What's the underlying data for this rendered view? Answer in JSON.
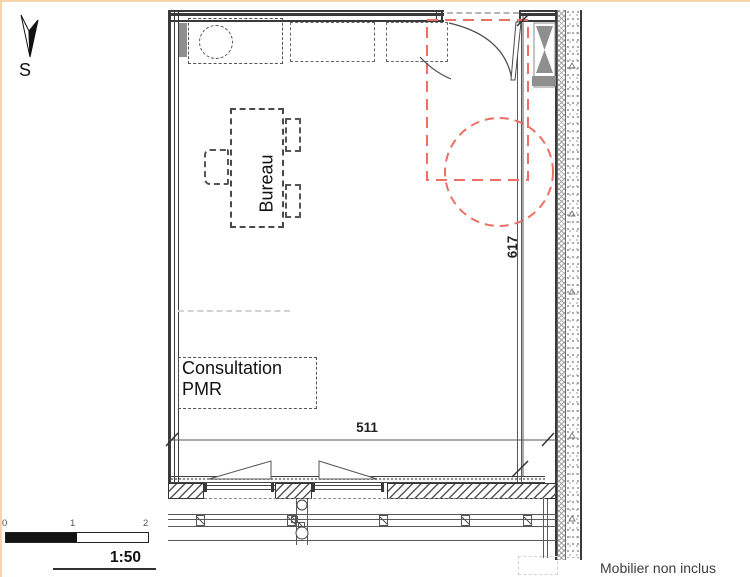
{
  "drawing": {
    "compass": {
      "label": "S"
    },
    "labels": {
      "desk": "Bureau",
      "room_line1": "Consultation",
      "room_line2": "PMR"
    },
    "dimensions": {
      "width": "511",
      "height": "617"
    },
    "scale_bar": {
      "tick0": "0",
      "tick1": "1",
      "tick2": "2",
      "ratio": "1:50"
    },
    "legend": {
      "furniture_note": "Mobilier non inclus"
    },
    "colors": {
      "line": "#3a3a3a",
      "accent_red": "#ec7063",
      "gray_fill": "#8f8f8f",
      "legend_swatch": "#d4d4d4",
      "frame_border": "#f8d4ab"
    }
  }
}
